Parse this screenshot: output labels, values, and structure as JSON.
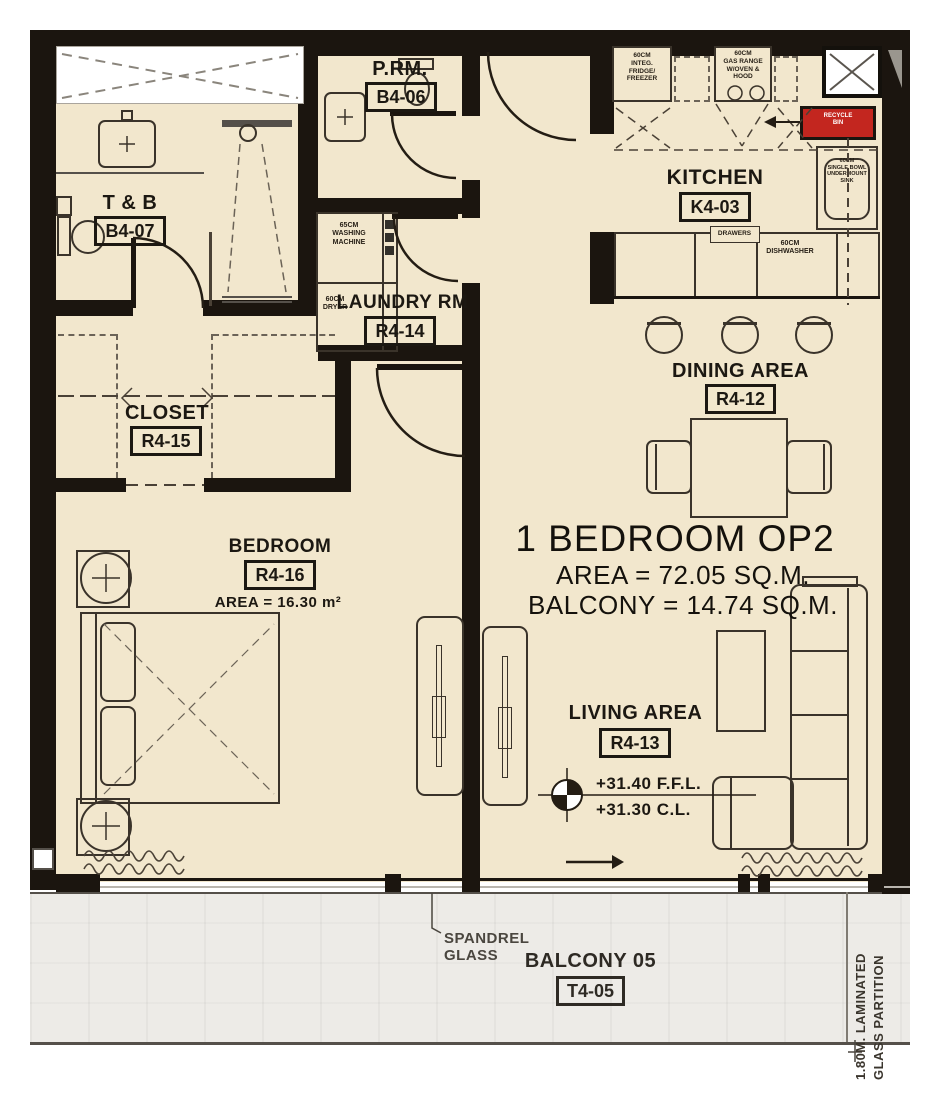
{
  "unit": {
    "title": "1 BEDROOM OP2",
    "area": "AREA = 72.05 SQ.M.",
    "balcony": "BALCONY = 14.74 SQ.M."
  },
  "rooms": {
    "tb": {
      "label": "T & B",
      "code": "B4-07"
    },
    "prm": {
      "label": "P.RM.",
      "code": "B4-06"
    },
    "laundry": {
      "label": "LAUNDRY RM",
      "code": "R4-14"
    },
    "closet": {
      "label": "CLOSET",
      "code": "R4-15"
    },
    "bedroom": {
      "label": "BEDROOM",
      "code": "R4-16",
      "area": "AREA = 16.30 m²"
    },
    "kitchen": {
      "label": "KITCHEN",
      "code": "K4-03"
    },
    "dining": {
      "label": "DINING AREA",
      "code": "R4-12"
    },
    "living": {
      "label": "LIVING AREA",
      "code": "R4-13"
    },
    "balcony": {
      "label": "BALCONY 05",
      "code": "T4-05"
    }
  },
  "fixtures": {
    "fridge": "60CM\nINTEG.\nFRIDGE/\nFREEZER",
    "gas_range": "60CM\nGAS RANGE\nW/OVEN &\nHOOD",
    "recycle_bin": "RECYCLE\nBIN",
    "sink": "60CM\nSINGLE BOWL\nUNDERMOUNT\nSINK",
    "drawers": "DRAWERS",
    "dishwasher": "60CM\nDISHWASHER",
    "washing_machine": "65CM\nWASHING\nMACHINE",
    "dryer": "60CM\nDRYER"
  },
  "levels": {
    "ffl": "+31.40 F.F.L.",
    "cl": "+31.30 C.L."
  },
  "notes": {
    "spandrel": "SPANDREL\nGLASS",
    "glass_partition": "1.80M. LAMINATED\nGLASS PARTITION"
  },
  "colors": {
    "floor": "#f2e7cd",
    "wall": "#1b150f",
    "balcony_floor": "#edebe7",
    "accent_red": "#c3261f",
    "line": "#3a332a"
  }
}
